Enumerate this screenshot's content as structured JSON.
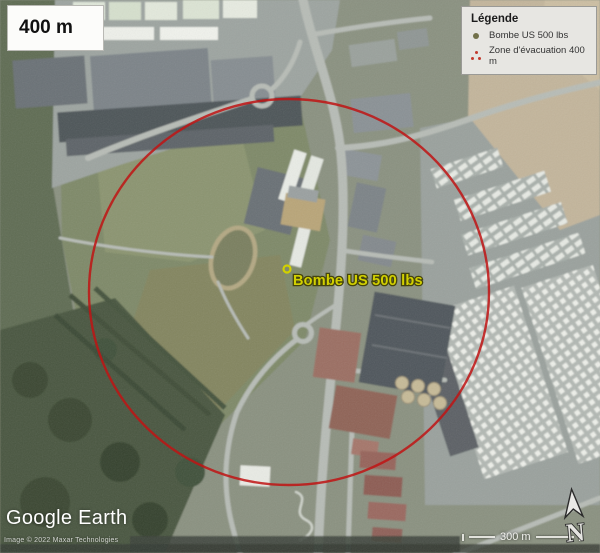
{
  "map": {
    "scale_box_label": "400 m",
    "marker_label": "Bombe US 500 lbs",
    "marker_color": "#d2d000",
    "evacuation_circle_color": "#c01414"
  },
  "legend": {
    "title": "Légende",
    "items": [
      {
        "icon": "bomb-point-icon",
        "label": "Bombe US 500 lbs",
        "color": "#72714a"
      },
      {
        "icon": "evacuation-zone-icon",
        "label": "Zone d'évacuation 400 m",
        "color": "#c23b2e"
      }
    ]
  },
  "watermark": {
    "brand": "Google Earth",
    "copyright": "Image © 2022 Maxar Technologies"
  },
  "scale_bar": {
    "label": "300 m"
  },
  "compass": {
    "label": "N"
  }
}
